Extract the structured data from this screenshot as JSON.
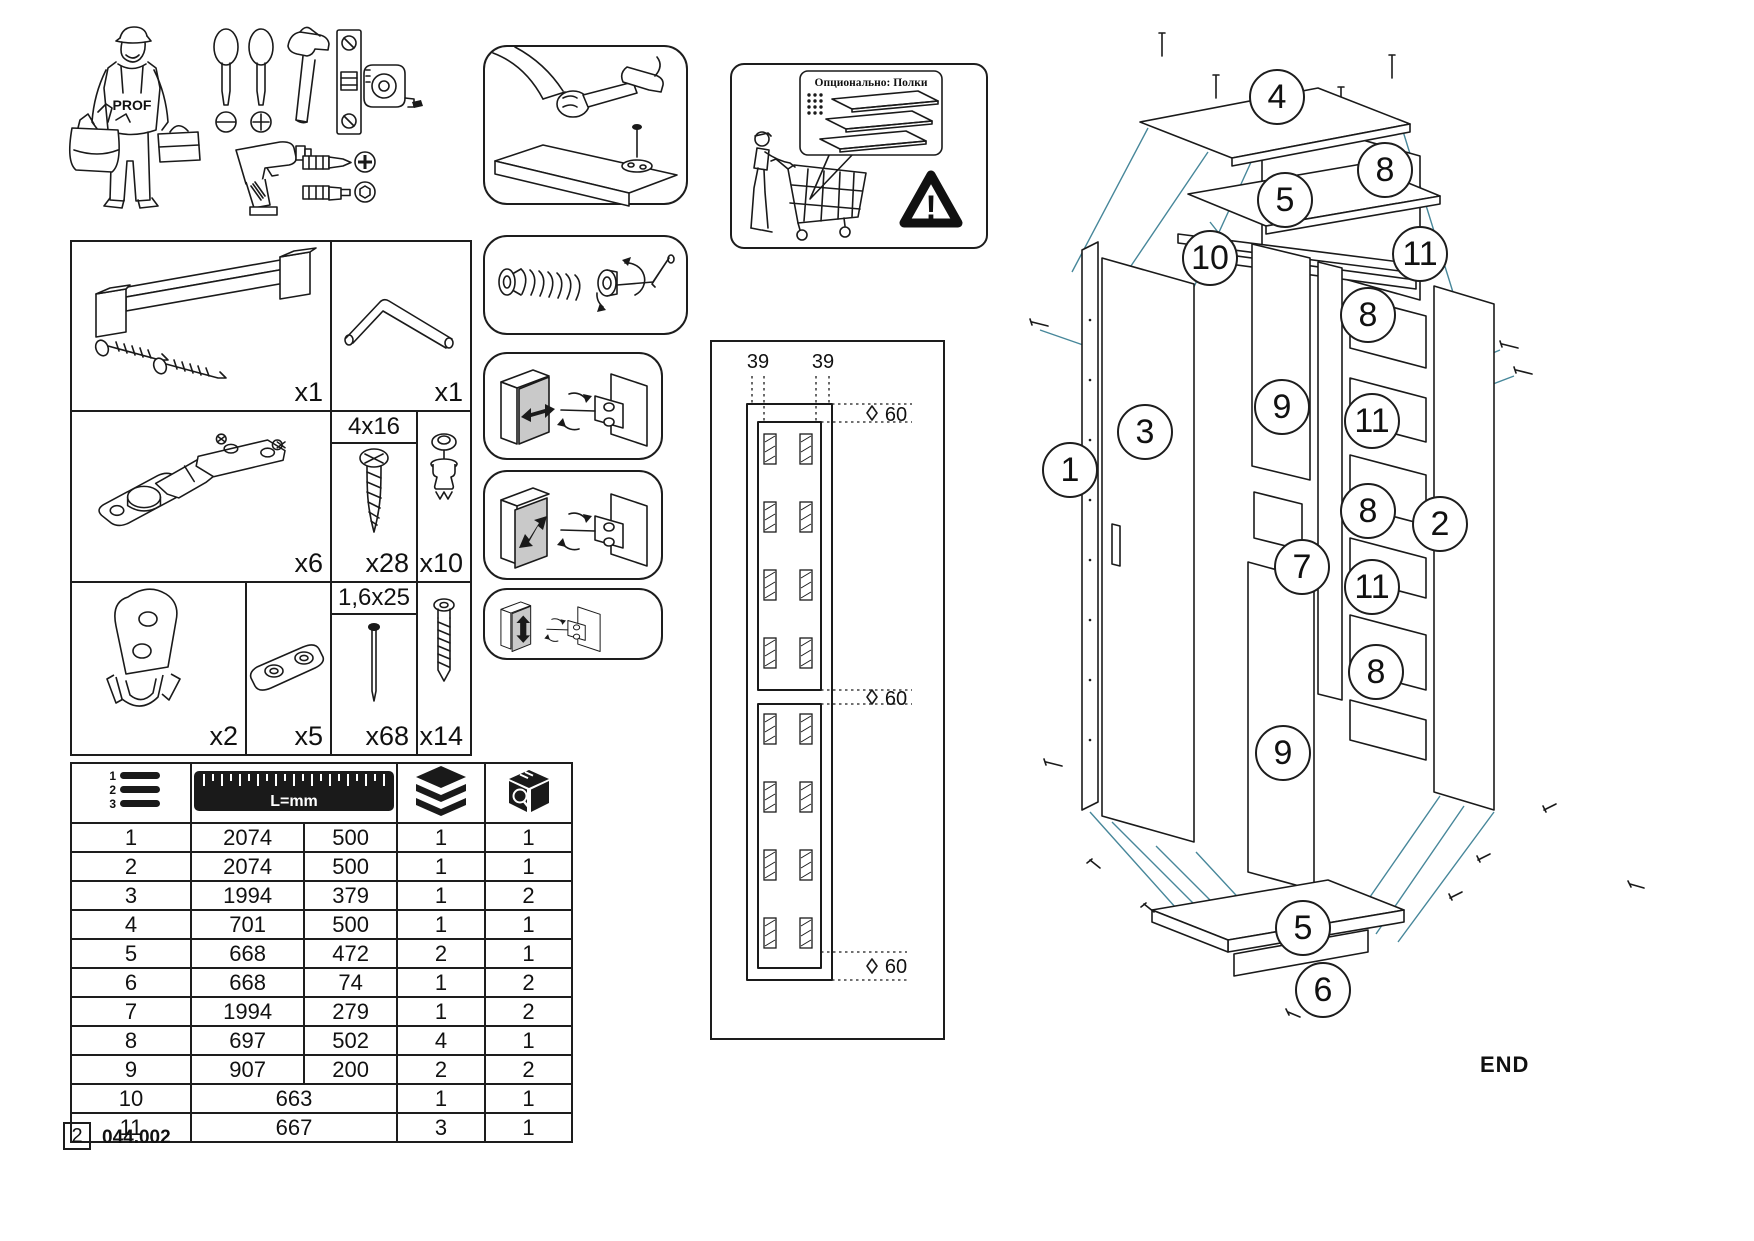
{
  "page": {
    "page_number": "2",
    "doc_code": "044.002",
    "end_label": "END"
  },
  "colors": {
    "line": "#1a1a1a",
    "leader_teal": "#47879a",
    "door_gray": "#c9c9c9"
  },
  "worker": {
    "vest_label": "PROF"
  },
  "hardware": {
    "handle_qty": "x1",
    "allen_key_qty": "x1",
    "hinge_qty": "x6",
    "screw_size": "4x16",
    "screw_qty": "x28",
    "cam_dowel_qty": "x10",
    "bracket_qty": "x2",
    "clip_qty": "x5",
    "nail_size": "1,6x25",
    "nail_qty": "x68",
    "confirmat_qty": "x14"
  },
  "parts_table": {
    "header": {
      "list_lines": [
        "1",
        "2",
        "3"
      ],
      "ruler_label": "L=mm"
    },
    "rows": [
      [
        "1",
        "2074",
        "500",
        "1",
        "1"
      ],
      [
        "2",
        "2074",
        "500",
        "1",
        "1"
      ],
      [
        "3",
        "1994",
        "379",
        "1",
        "2"
      ],
      [
        "4",
        "701",
        "500",
        "1",
        "1"
      ],
      [
        "5",
        "668",
        "472",
        "2",
        "1"
      ],
      [
        "6",
        "668",
        "74",
        "1",
        "2"
      ],
      [
        "7",
        "1994",
        "279",
        "1",
        "2"
      ],
      [
        "8",
        "697",
        "502",
        "4",
        "1"
      ],
      [
        "9",
        "907",
        "200",
        "2",
        "2"
      ],
      [
        "10",
        "663",
        "",
        "1",
        "1"
      ],
      [
        "11",
        "667",
        "",
        "3",
        "1"
      ]
    ]
  },
  "optional_panel": {
    "bubble_text": "Опционально: Полки",
    "warning_mark": "!"
  },
  "drill_template": {
    "dim_col_left": "39",
    "dim_col_right": "39",
    "dim_top": "60",
    "dim_middle": "60",
    "dim_bottom": "60"
  },
  "exploded_view": {
    "callouts": [
      {
        "label": "4",
        "x": 1277,
        "y": 97
      },
      {
        "label": "8",
        "x": 1385,
        "y": 170
      },
      {
        "label": "5",
        "x": 1285,
        "y": 200
      },
      {
        "label": "10",
        "x": 1210,
        "y": 258
      },
      {
        "label": "11",
        "x": 1420,
        "y": 254
      },
      {
        "label": "8",
        "x": 1368,
        "y": 315
      },
      {
        "label": "9",
        "x": 1282,
        "y": 407
      },
      {
        "label": "11",
        "x": 1372,
        "y": 421
      },
      {
        "label": "3",
        "x": 1145,
        "y": 432
      },
      {
        "label": "1",
        "x": 1070,
        "y": 470
      },
      {
        "label": "8",
        "x": 1368,
        "y": 511
      },
      {
        "label": "2",
        "x": 1440,
        "y": 524
      },
      {
        "label": "7",
        "x": 1302,
        "y": 567
      },
      {
        "label": "11",
        "x": 1372,
        "y": 587
      },
      {
        "label": "8",
        "x": 1376,
        "y": 672
      },
      {
        "label": "9",
        "x": 1283,
        "y": 753
      },
      {
        "label": "5",
        "x": 1303,
        "y": 928
      },
      {
        "label": "6",
        "x": 1323,
        "y": 990
      }
    ]
  }
}
